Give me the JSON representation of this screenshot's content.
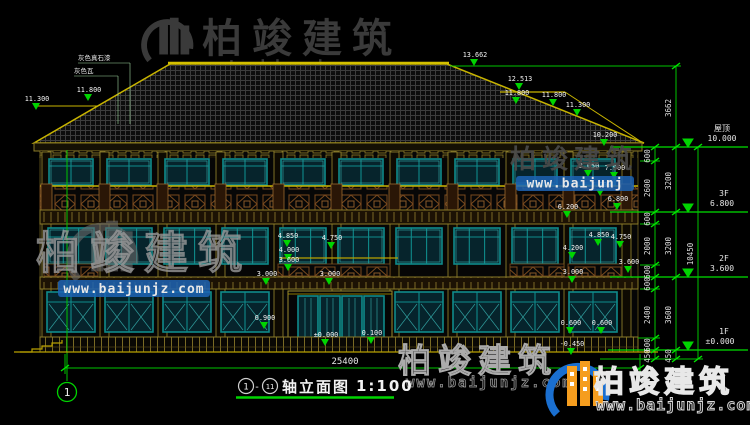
{
  "title": {
    "axis_start": "1",
    "dash": "-",
    "axis_end": "11",
    "name": "轴立面图",
    "scale": "1:100"
  },
  "axis_bubble": {
    "label": "1"
  },
  "watermark": {
    "brand": "柏竣建筑",
    "url": "www.baijunjz.com",
    "url_short": "www.baijunj"
  },
  "colors": {
    "dim_green": "#00c300",
    "outline_yellow": "#b8a000",
    "window_teal": "#0f8b8b",
    "railing_brown": "#7a4a1e",
    "logo_blue": "#1a6fd0",
    "logo_orange": "#f59d1e"
  },
  "annotations": {
    "floor_levels": [
      {
        "t": "屋顶",
        "x": 722,
        "y": 131,
        "zh": true
      },
      {
        "t": "10.000",
        "x": 722,
        "y": 141
      },
      {
        "t": "3F",
        "x": 724,
        "y": 196
      },
      {
        "t": "6.800",
        "x": 722,
        "y": 206
      },
      {
        "t": "2F",
        "x": 724,
        "y": 261
      },
      {
        "t": "3.600",
        "x": 722,
        "y": 271
      },
      {
        "t": "1F",
        "x": 724,
        "y": 334
      },
      {
        "t": "±0.000",
        "x": 720,
        "y": 344
      }
    ],
    "dim_texts": [
      {
        "t": "600",
        "x": 650,
        "y": 156,
        "r": 1
      },
      {
        "t": "2600",
        "x": 650,
        "y": 188,
        "r": 1
      },
      {
        "t": "600",
        "x": 650,
        "y": 219,
        "r": 1
      },
      {
        "t": "2000",
        "x": 650,
        "y": 246,
        "r": 1
      },
      {
        "t": "600",
        "x": 650,
        "y": 272,
        "r": 1
      },
      {
        "t": "600",
        "x": 650,
        "y": 284,
        "r": 1
      },
      {
        "t": "2400",
        "x": 650,
        "y": 315,
        "r": 1
      },
      {
        "t": "600",
        "x": 650,
        "y": 345,
        "r": 1
      },
      {
        "t": "450",
        "x": 650,
        "y": 356,
        "r": 1
      },
      {
        "t": "3662",
        "x": 671,
        "y": 108,
        "r": 1
      },
      {
        "t": "3200",
        "x": 671,
        "y": 181,
        "r": 1
      },
      {
        "t": "3200",
        "x": 671,
        "y": 246,
        "r": 1
      },
      {
        "t": "3600",
        "x": 671,
        "y": 315,
        "r": 1
      },
      {
        "t": "450",
        "x": 671,
        "y": 356,
        "r": 1
      },
      {
        "t": "10450",
        "x": 693,
        "y": 254,
        "r": 1
      },
      {
        "t": "25400",
        "x": 345,
        "y": 364,
        "c": "wt bd"
      }
    ],
    "material_labels": [
      {
        "t": "灰色真石漆",
        "x": 78,
        "y": 60,
        "c": "wt zh xs"
      },
      {
        "t": "灰色瓦",
        "x": 74,
        "y": 73,
        "c": "wt zh xs"
      }
    ],
    "elevation_markers": [
      {
        "v": "13.662",
        "x": 474,
        "y": 66
      },
      {
        "v": "12.513",
        "x": 519,
        "y": 90
      },
      {
        "v": "11.800",
        "x": 516,
        "y": 104
      },
      {
        "v": "11.800",
        "x": 553,
        "y": 106
      },
      {
        "v": "11.300",
        "x": 577,
        "y": 116
      },
      {
        "v": "11.800",
        "x": 88,
        "y": 101
      },
      {
        "v": "11.300",
        "x": 36,
        "y": 110
      },
      {
        "v": "10.200",
        "x": 604,
        "y": 146
      },
      {
        "v": "8.050",
        "x": 588,
        "y": 177
      },
      {
        "v": "7.900",
        "x": 614,
        "y": 179
      },
      {
        "v": "7.200",
        "x": 600,
        "y": 196
      },
      {
        "v": "6.800",
        "x": 617,
        "y": 210
      },
      {
        "v": "6.200",
        "x": 567,
        "y": 218
      },
      {
        "v": "4.850",
        "x": 598,
        "y": 246
      },
      {
        "v": "4.750",
        "x": 620,
        "y": 248
      },
      {
        "v": "4.200",
        "x": 572,
        "y": 259
      },
      {
        "v": "3.600",
        "x": 628,
        "y": 273
      },
      {
        "v": "3.000",
        "x": 572,
        "y": 283
      },
      {
        "v": "0.600",
        "x": 570,
        "y": 334
      },
      {
        "v": "0.600",
        "x": 601,
        "y": 334
      },
      {
        "v": "-0.450",
        "x": 571,
        "y": 355
      },
      {
        "v": "4.850",
        "x": 287,
        "y": 247
      },
      {
        "v": "4.750",
        "x": 331,
        "y": 249
      },
      {
        "v": "4.000",
        "x": 288,
        "y": 261
      },
      {
        "v": "3.600",
        "x": 288,
        "y": 271
      },
      {
        "v": "3.000",
        "x": 266,
        "y": 285
      },
      {
        "v": "3.000",
        "x": 329,
        "y": 285
      },
      {
        "v": "0.900",
        "x": 264,
        "y": 329
      },
      {
        "v": "±0.000",
        "x": 325,
        "y": 346
      },
      {
        "v": "0.100",
        "x": 371,
        "y": 344
      }
    ],
    "level_triangles": [
      {
        "x": 688,
        "y": 147
      },
      {
        "x": 688,
        "y": 212
      },
      {
        "x": 688,
        "y": 277
      },
      {
        "x": 688,
        "y": 350
      }
    ],
    "lines": [
      [
        610,
        147,
        748,
        147,
        "gl lv"
      ],
      [
        610,
        212,
        748,
        212,
        "gl lv"
      ],
      [
        610,
        277,
        748,
        277,
        "gl lv"
      ],
      [
        608,
        350,
        748,
        350,
        "gl lv"
      ],
      [
        640,
        161,
        660,
        161,
        "gl"
      ],
      [
        640,
        224,
        660,
        224,
        "gl"
      ],
      [
        640,
        265,
        660,
        265,
        "gl"
      ],
      [
        640,
        289,
        660,
        289,
        "gl"
      ],
      [
        638,
        338,
        660,
        338,
        "gl"
      ],
      [
        600,
        359,
        703,
        359,
        "gl"
      ],
      [
        450,
        66,
        681,
        66,
        "gl"
      ],
      [
        655,
        147,
        655,
        359,
        "gl"
      ],
      [
        676,
        66,
        676,
        359,
        "gl"
      ],
      [
        698,
        147,
        698,
        359,
        "gl"
      ],
      [
        65,
        368,
        640,
        368,
        "gl"
      ],
      [
        65,
        354,
        65,
        374,
        "gl"
      ],
      [
        640,
        354,
        640,
        374,
        "gl"
      ],
      [
        67,
        150,
        67,
        381,
        "gl"
      ],
      [
        14,
        352,
        658,
        352,
        "yl"
      ],
      [
        280,
        258,
        398,
        258,
        "yl"
      ],
      [
        78,
        63,
        130,
        63,
        "wl"
      ],
      [
        130,
        63,
        130,
        124,
        "wl"
      ],
      [
        74,
        76,
        118,
        76,
        "wl"
      ],
      [
        118,
        76,
        118,
        124,
        "wl"
      ]
    ],
    "ticks": [
      {
        "x": 655,
        "y": 147
      },
      {
        "x": 655,
        "y": 161
      },
      {
        "x": 655,
        "y": 212
      },
      {
        "x": 655,
        "y": 224
      },
      {
        "x": 655,
        "y": 265
      },
      {
        "x": 655,
        "y": 277
      },
      {
        "x": 655,
        "y": 289
      },
      {
        "x": 655,
        "y": 338
      },
      {
        "x": 655,
        "y": 350
      },
      {
        "x": 655,
        "y": 359
      },
      {
        "x": 676,
        "y": 66
      },
      {
        "x": 676,
        "y": 147
      },
      {
        "x": 676,
        "y": 212
      },
      {
        "x": 676,
        "y": 277
      },
      {
        "x": 676,
        "y": 350
      },
      {
        "x": 676,
        "y": 359
      },
      {
        "x": 698,
        "y": 147
      },
      {
        "x": 698,
        "y": 359
      },
      {
        "x": 65,
        "y": 368
      },
      {
        "x": 640,
        "y": 368
      }
    ]
  }
}
